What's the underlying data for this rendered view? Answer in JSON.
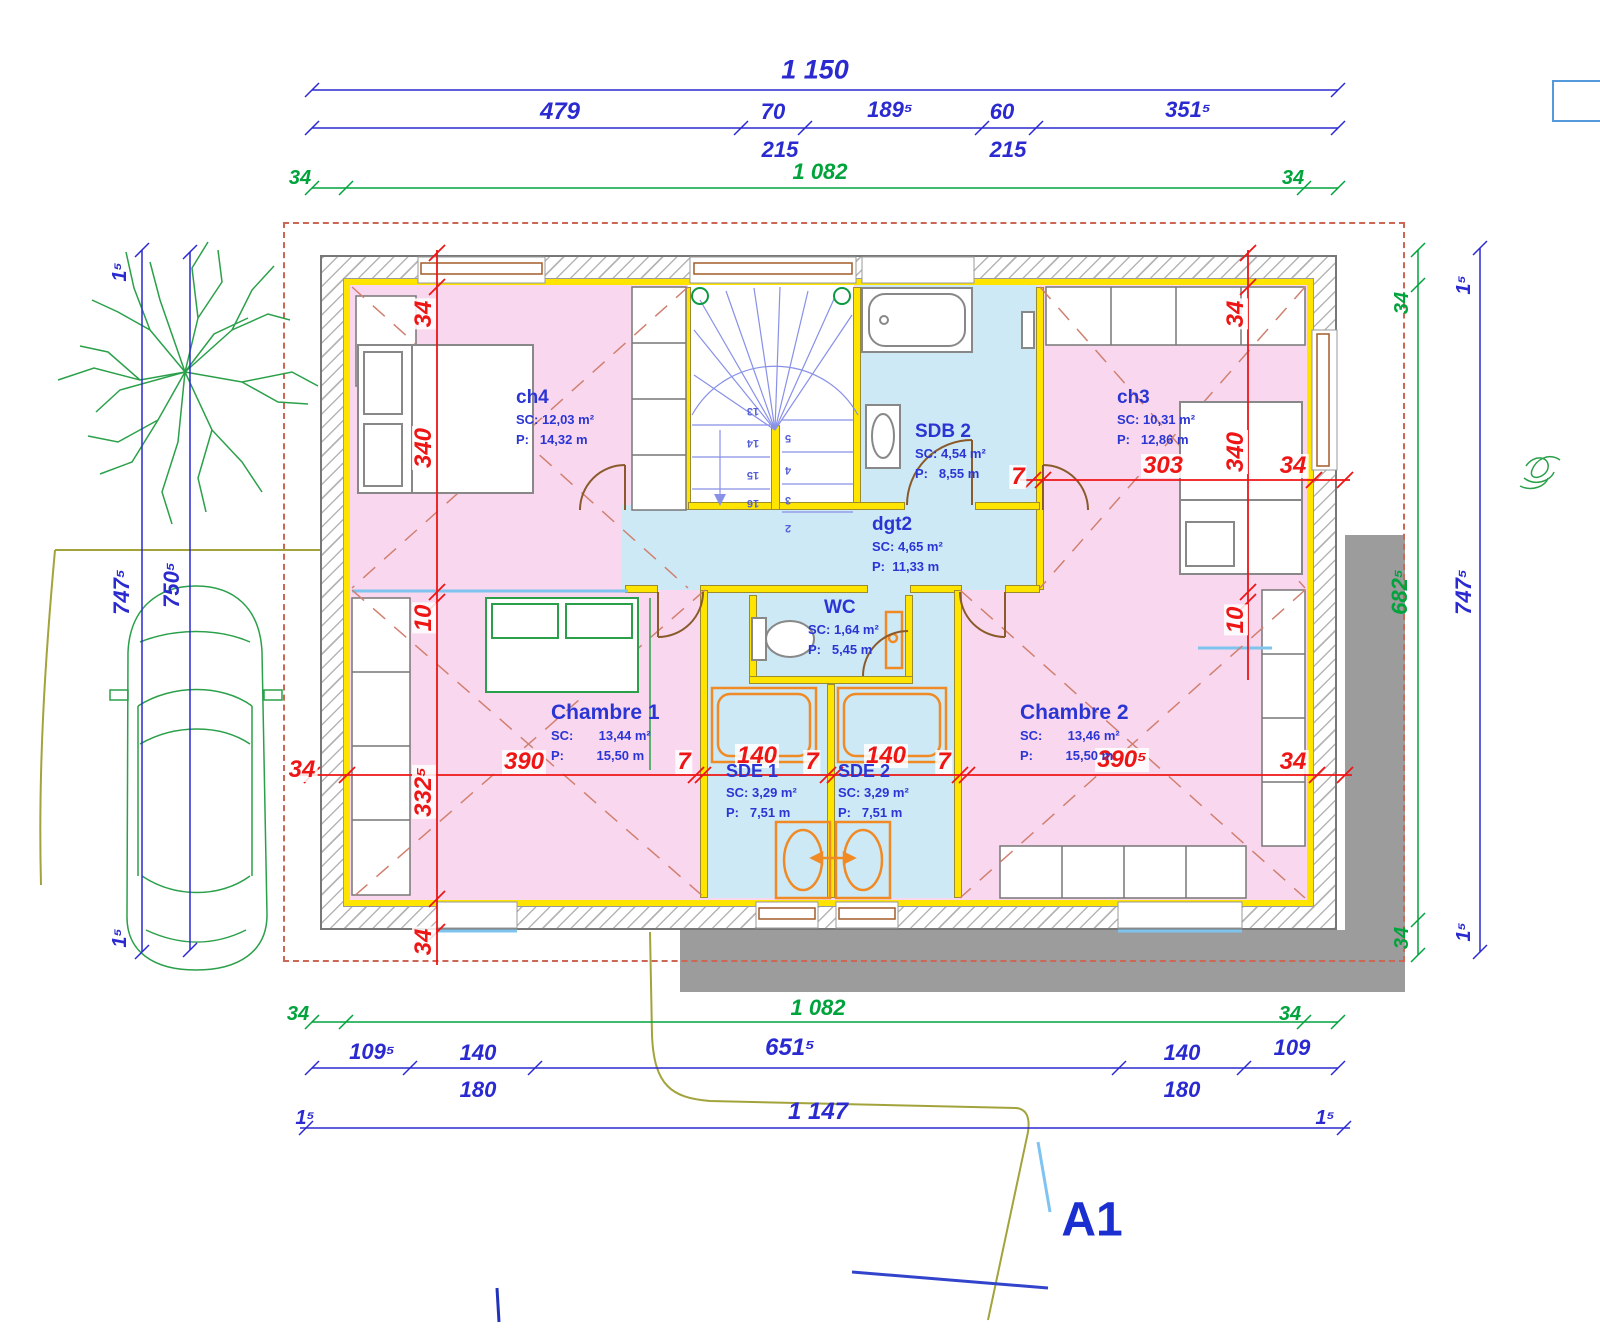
{
  "drawing": {
    "title_label": "A1"
  },
  "rooms": {
    "ch4": {
      "name": "ch4",
      "sc": "SC: 12,03 m²",
      "p": "P:   14,32 m"
    },
    "sdb2": {
      "name": "SDB 2",
      "sc": "SC: 4,54 m²",
      "p": "P:   8,55 m"
    },
    "ch3": {
      "name": "ch3",
      "sc": "SC: 10,31 m²",
      "p": "P:   12,86 m"
    },
    "dgt2": {
      "name": "dgt2",
      "sc": "SC: 4,65 m²",
      "p": "P:  11,33 m"
    },
    "wc": {
      "name": "WC",
      "sc": "SC: 1,64 m²",
      "p": "P:   5,45 m"
    },
    "chambre1": {
      "name": "Chambre 1",
      "sc": "SC:       13,44 m²",
      "p": "P:         15,50 m"
    },
    "sde1": {
      "name": "SDE 1",
      "sc": "SC: 3,29 m²",
      "p": "P:   7,51 m"
    },
    "sde2": {
      "name": "SDE 2",
      "sc": "SC: 3,29 m²",
      "p": "P:   7,51 m"
    },
    "chambre2": {
      "name": "Chambre 2",
      "sc": "SC:       13,46 m²",
      "p": "P:         15,50 m"
    }
  },
  "dims": {
    "top_total": "1 150",
    "top_segments": [
      "479",
      "70",
      "189⁵",
      "60",
      "351⁵"
    ],
    "top_subs": [
      "215",
      "215"
    ],
    "green_top": [
      "34",
      "1 082",
      "34"
    ],
    "left_blue": [
      "1⁵",
      "747⁵",
      "750⁵",
      "1⁵"
    ],
    "right_green": [
      "34",
      "682⁵",
      "34"
    ],
    "right_blue": [
      "1⁵",
      "747⁵",
      "1⁵"
    ],
    "red_left_col": [
      "34",
      "340",
      "10",
      "332⁵",
      "34"
    ],
    "red_right_col": [
      "34",
      "340",
      "10"
    ],
    "red_h_upper": [
      "7",
      "303",
      "34"
    ],
    "red_h_mid": [
      "34",
      "390",
      "7",
      "140",
      "7",
      "140",
      "7",
      "390⁵",
      "34"
    ],
    "green_bottom": [
      "34",
      "1 082",
      "34"
    ],
    "bottom_chain": [
      "109⁵",
      "140",
      "651⁵",
      "140",
      "109"
    ],
    "bottom_subs": [
      "180",
      "180"
    ],
    "bottom_total": [
      "1⁵",
      "1 147",
      "1⁵"
    ]
  },
  "stairs": {
    "left": [
      "13",
      "14",
      "15",
      "16"
    ],
    "right": [
      "5",
      "4",
      "3",
      "2"
    ]
  },
  "colors": {
    "dim_blue": "#2a2ad0",
    "dim_green": "#00a33c",
    "dim_red": "#ee1515",
    "room_pink": "#f9d8ef",
    "room_blue": "#cde9f6",
    "insulation_yellow": "#ffe400",
    "terrace_gray": "#9c9c9c",
    "landscape_green": "#2ba04a",
    "boundary_olive": "#a3a33c",
    "door_brown": "#8a5a2b"
  }
}
